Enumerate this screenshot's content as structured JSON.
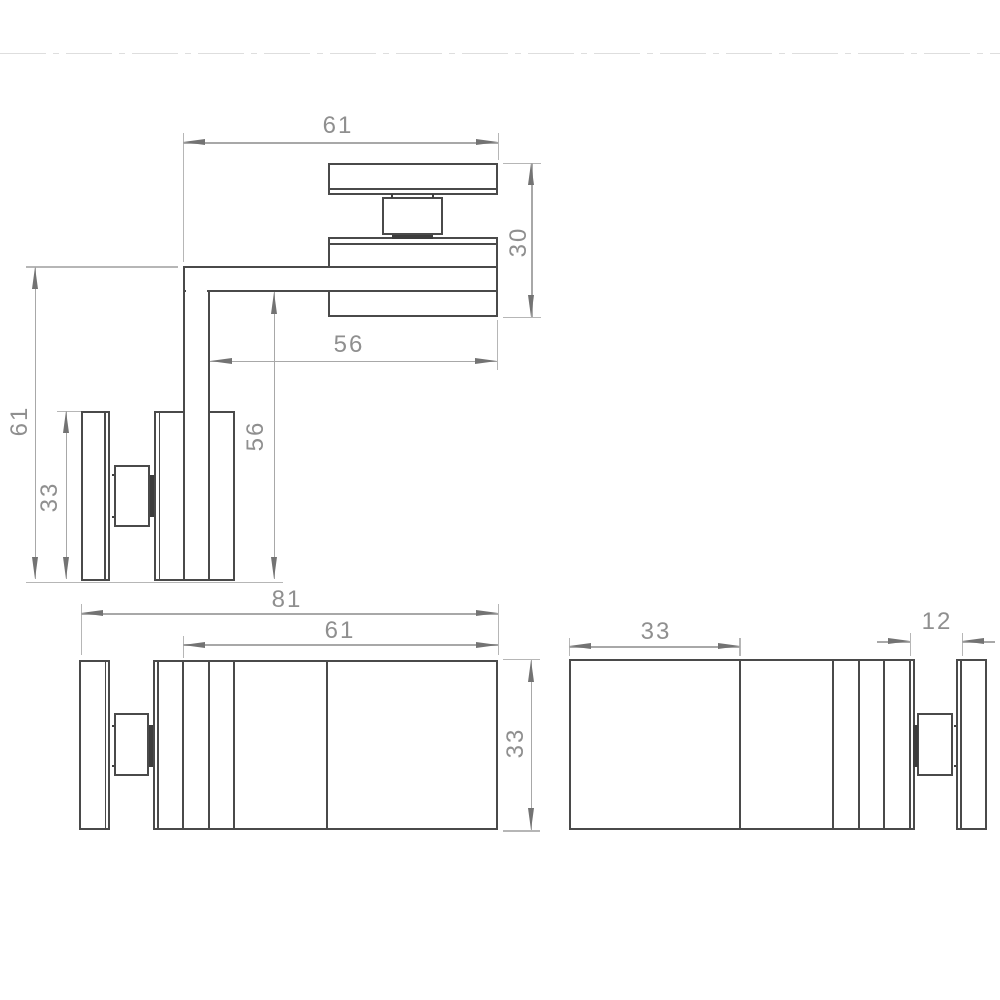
{
  "drawing": {
    "kind": "technical-drawing-glass-corner-clamp",
    "colors": {
      "object_line": "#4a4a4a",
      "dim_line": "#a8a8a8",
      "dim_text": "#8f8f8f"
    },
    "views": {
      "plan": {
        "dim_arm_top": "61",
        "dim_clamp_width": "30",
        "dim_inner_horizontal": "56",
        "dim_inner_vertical": "56",
        "dim_arm_left": "61",
        "dim_plate_length": "33"
      },
      "front": {
        "dim_overall": "81",
        "dim_arm": "61",
        "dim_height": "33"
      },
      "side": {
        "dim_face": "33",
        "dim_slot": "12"
      }
    }
  }
}
